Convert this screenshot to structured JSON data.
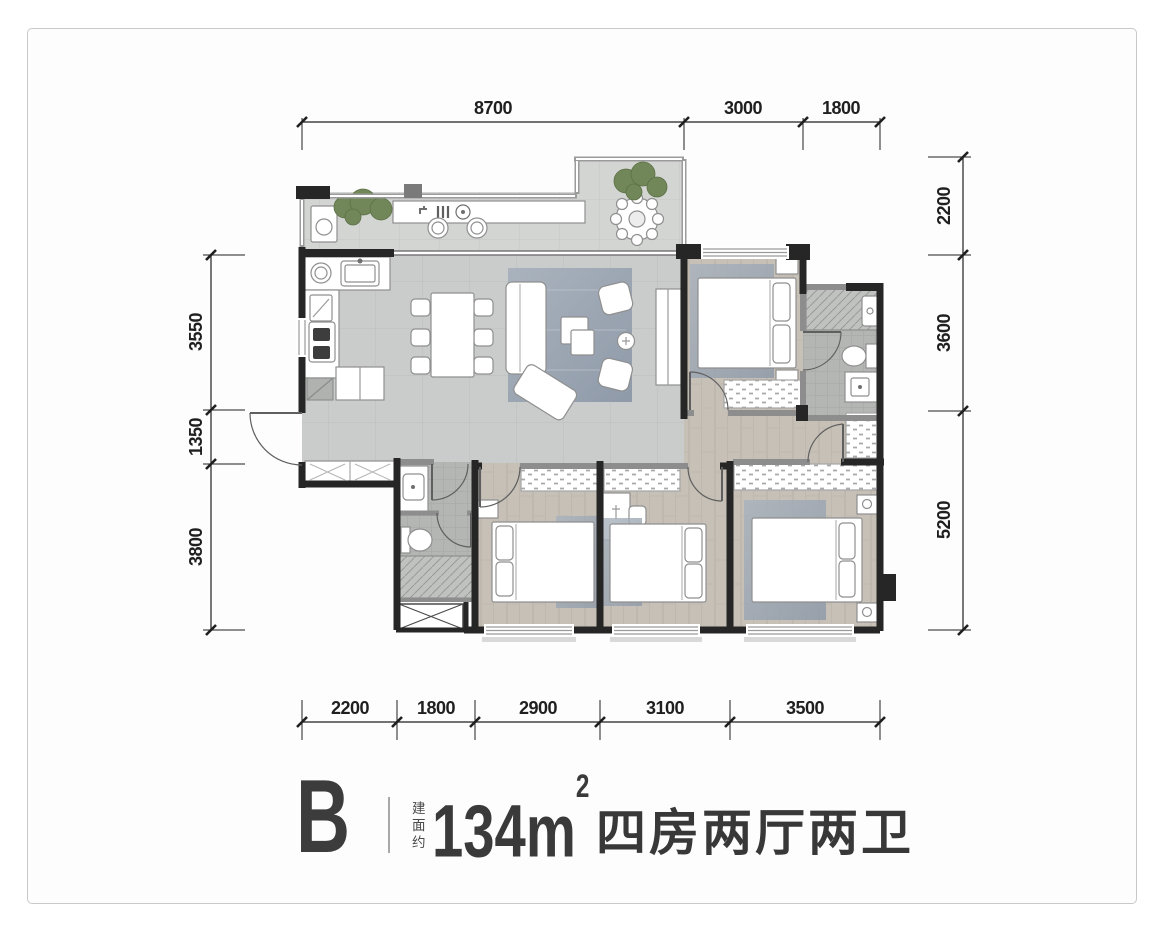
{
  "dimensions": {
    "top": [
      "8700",
      "3000",
      "1800"
    ],
    "right": [
      "2200",
      "3600",
      "5200"
    ],
    "bottom": [
      "2200",
      "1800",
      "2900",
      "3100",
      "3500"
    ],
    "left": [
      "3550",
      "1350",
      "3800"
    ]
  },
  "title_block": {
    "unit_label": "B",
    "area_prefix": "建面约",
    "area_value": "134m",
    "area_exponent": "2",
    "rooms_label": "四房两厅两卫"
  },
  "colors": {
    "wall": "#262626",
    "partition_wall": "#8d8d8d",
    "tile_floor": "#cacccb",
    "balcony_floor": "#d3d5d3",
    "wood_floor": "#c6c0b7",
    "bath_floor": "#b4b6b4",
    "rug": "#a2acb9",
    "greenery": "#71875a",
    "dimension_ink": "#1f1f1f",
    "card_border": "#c9c9c9"
  }
}
